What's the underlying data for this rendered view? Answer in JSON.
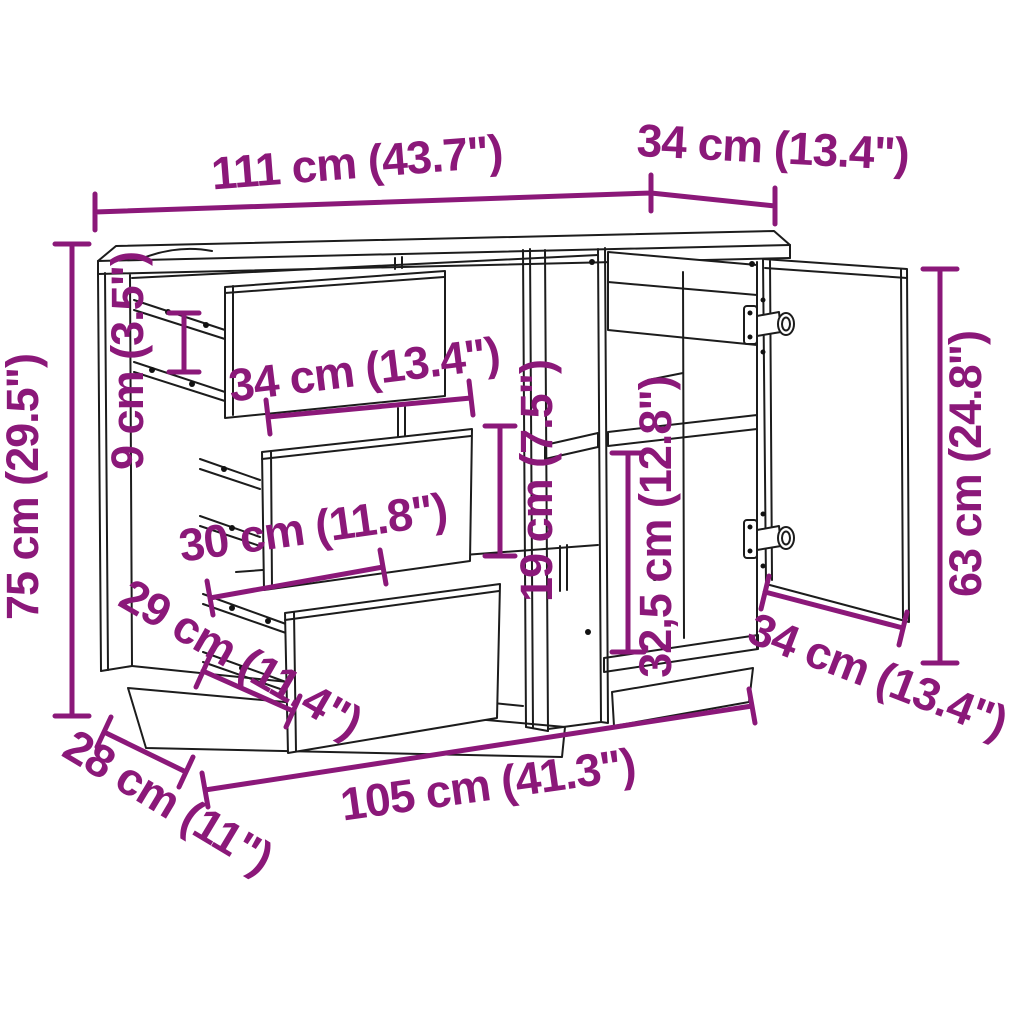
{
  "diagram": {
    "depicts": "sideboard line drawing with three drawers, open door, shelves and dimension annotations",
    "colors": {
      "dimension_accent": "#8b1879",
      "line_art": "#1c1c1c",
      "background": "#ffffff"
    },
    "dimensions": [
      {
        "id": "total-width-top",
        "label": "111 cm (43.7\")"
      },
      {
        "id": "top-depth",
        "label": "34 cm (13.4\")"
      },
      {
        "id": "total-height",
        "label": "75 cm (29.5\")"
      },
      {
        "id": "drawer-side-height",
        "label": "9 cm (3.5\")"
      },
      {
        "id": "drawer-front-width",
        "label": "34 cm (13.4\")"
      },
      {
        "id": "drawer-inner-width",
        "label": "30 cm (11.8\")"
      },
      {
        "id": "middle-shelf-gap",
        "label": "19 cm (7.5\")"
      },
      {
        "id": "compartment-height",
        "label": "32,5 cm (12.8\")"
      },
      {
        "id": "door-height",
        "label": "63 cm (24.8\")"
      },
      {
        "id": "drawer-depth",
        "label": "29 cm (11.4\")"
      },
      {
        "id": "base-depth",
        "label": "28 cm (11\")"
      },
      {
        "id": "bottom-width",
        "label": "105 cm (41.3\")"
      },
      {
        "id": "door-width",
        "label": "34 cm (13.4\")"
      }
    ]
  }
}
